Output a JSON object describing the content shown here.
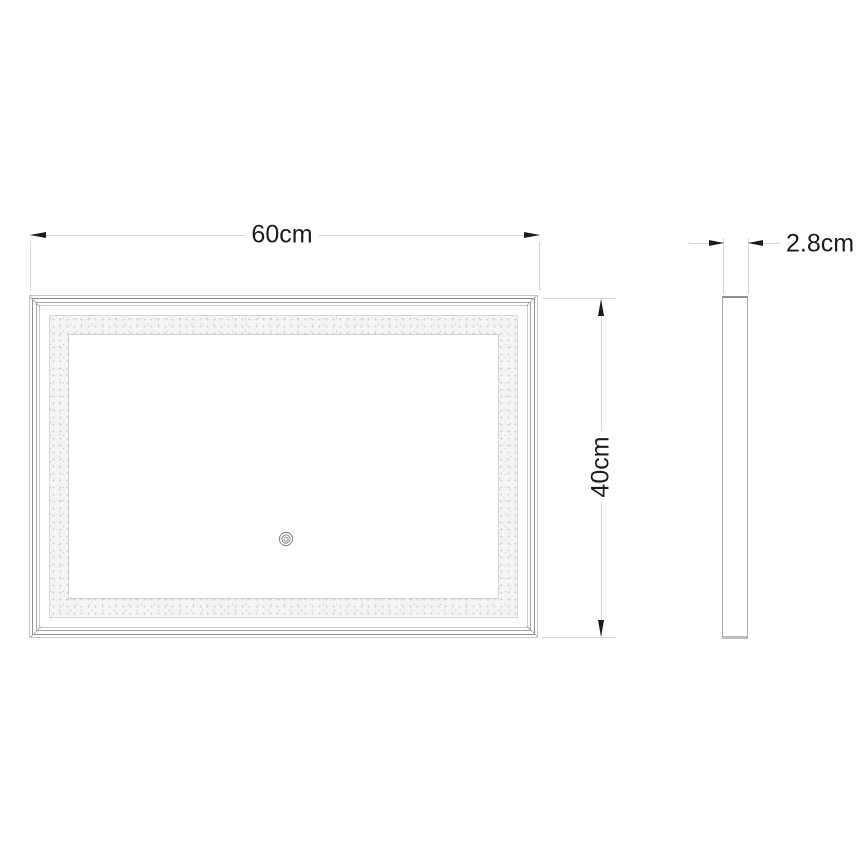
{
  "drawing": {
    "dimensions": {
      "width": {
        "label": "60cm"
      },
      "height": {
        "label": "40cm"
      },
      "depth": {
        "label": "2.8cm"
      }
    },
    "icons": {
      "power_touch": "power-symbol-in-double-circle",
      "arrowheads": "filled-black-triangle"
    },
    "colors": {
      "background": "#ffffff",
      "dimension_line": "#d6d6d6",
      "arrow_and_text": "#1c1c1c",
      "frame_line": "#8f8f8f",
      "diffuser_fill": "#f4f4f4",
      "power_icon": "#8a8a8a"
    }
  }
}
